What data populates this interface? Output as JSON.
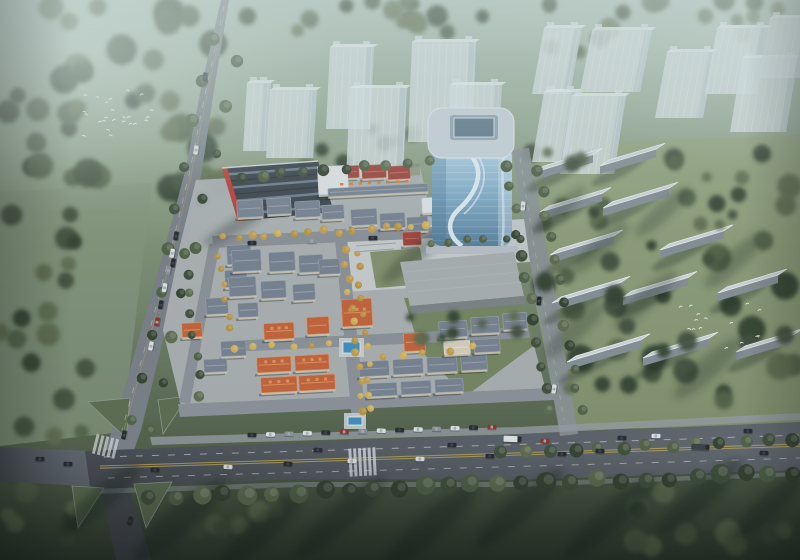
{
  "palette": {
    "g_base_1": "#a9bcb4",
    "g_base_2": "#99ab97",
    "g_base_3": "#87987d",
    "g_base_4": "#72826a",
    "g_base_5": "#55634c",
    "g_base_6": "#333f30",
    "forest_dark": "#33402f",
    "forest_mid": "#3f4d3a",
    "forest_light": "#4f5f45",
    "forest_pale": "#5d6b4e",
    "meadow": "#83937b",
    "lawn_right": "#93a179",
    "grass_island": "#5a6a4e",
    "garden_green": "#6f7f59",
    "lawn_pocket": "#7b8a63",
    "asphalt": "#545960",
    "asphalt_dark": "#43474e",
    "road_mist": "#787d85",
    "street": "#8a8f96",
    "paving": "#aeb2b6",
    "plaza": "#c6cacd",
    "sidewalk": "#949aa1",
    "lane_yellow": "#b5a057",
    "lane_white": "#d6dade",
    "ghost_body": "#d7e0e6",
    "ghost_shade": "#aebcc4",
    "ghost_roof": "#eaf0f3",
    "glass_1": "#b3d2e6",
    "glass_2": "#7fa9c7",
    "glass_3": "#577f9c",
    "swoosh": "#eef6fa",
    "tower_roof": "#c7d1d9",
    "tower_inset_frame": "#8fa3b2",
    "tower_inset": "#5d7689",
    "tower_base": "#b6bdc4",
    "sawtooth_dark": "#39414a",
    "sawtooth_glass": "#6c7d8d",
    "accent_red": "#bf3a31",
    "parapet": "#cdd3d8",
    "roof_gray": "#76808f",
    "roof_gray_ridge": "#9aa3af",
    "roof_orange": "#c2613a",
    "roof_orange_ridge": "#e0935c",
    "roof_red": "#9c423a",
    "roof_red_ridge": "#c4685c",
    "roof_cream": "#d6cdbd",
    "wall_light": "#e0e3e6",
    "wall_cream": "#cfc5b4",
    "slab_roof": "#ccd3d8",
    "slab_face": "#848d94",
    "slab_edge": "#eef2f4",
    "tree_yellow_1": "#c19c49",
    "tree_yellow_2": "#d1af57",
    "tree_yellow_3": "#b8933f",
    "pool": "#3e8cba",
    "pool_deck": "#c9cdd0",
    "car_dark": "#23272c",
    "car_white": "#dde1e4",
    "car_red": "#8e2f26",
    "car_gray": "#8b9097",
    "truck_trailer": "#3a3f45",
    "bird": "#f2f5f3",
    "shadow": "#16211a",
    "awning": "#d97f35"
  },
  "scene": {
    "forest_regions": [
      [
        5,
        5,
        220,
        195,
        40,
        8,
        16
      ],
      [
        0,
        195,
        92,
        195,
        14,
        7,
        12
      ],
      [
        228,
        0,
        290,
        38,
        14,
        6,
        11
      ],
      [
        300,
        118,
        130,
        48,
        8,
        5,
        9
      ],
      [
        528,
        148,
        268,
        255,
        30,
        7,
        14
      ],
      [
        580,
        492,
        220,
        62,
        12,
        8,
        14
      ],
      [
        0,
        388,
        82,
        170,
        12,
        7,
        12
      ],
      [
        150,
        498,
        130,
        58,
        8,
        7,
        11
      ],
      [
        530,
        0,
        268,
        52,
        16,
        6,
        11
      ]
    ],
    "forest_after": [
      [
        532,
        150,
        262,
        250,
        24,
        5,
        10
      ],
      [
        404,
        300,
        118,
        44,
        10,
        4,
        7
      ]
    ],
    "tree_rows": [
      {
        "x1": 150,
        "y1": 497,
        "x2": 795,
        "y2": 473,
        "n": 27,
        "rmin": 7,
        "rmax": 10,
        "kind": "green"
      },
      {
        "x1": 500,
        "y1": 452,
        "x2": 795,
        "y2": 441,
        "n": 13,
        "rmin": 5.5,
        "rmax": 7.5,
        "kind": "green"
      },
      {
        "x1": 212,
        "y1": 38,
        "x2": 132,
        "y2": 418,
        "n": 10,
        "rmin": 5,
        "rmax": 7,
        "kind": "green"
      },
      {
        "x1": 236,
        "y1": 62,
        "x2": 152,
        "y2": 430,
        "n": 9,
        "rmin": 4.5,
        "rmax": 6.5,
        "kind": "green"
      },
      {
        "x1": 506,
        "y1": 166,
        "x2": 549,
        "y2": 410,
        "n": 12,
        "rmin": 4.5,
        "rmax": 6,
        "kind": "green"
      },
      {
        "x1": 539,
        "y1": 172,
        "x2": 581,
        "y2": 412,
        "n": 12,
        "rmin": 4.5,
        "rmax": 6,
        "kind": "green"
      },
      {
        "x1": 344,
        "y1": 250,
        "x2": 362,
        "y2": 412,
        "n": 12,
        "rmin": 3,
        "rmax": 4.2,
        "kind": "yellow"
      },
      {
        "x1": 356,
        "y1": 252,
        "x2": 373,
        "y2": 410,
        "n": 11,
        "rmin": 2.8,
        "rmax": 3.8,
        "kind": "yellow"
      },
      {
        "x1": 222,
        "y1": 237,
        "x2": 428,
        "y2": 226,
        "n": 15,
        "rmin": 3,
        "rmax": 4.2,
        "kind": "yellow"
      },
      {
        "x1": 216,
        "y1": 254,
        "x2": 231,
        "y2": 330,
        "n": 6,
        "rmin": 2.8,
        "rmax": 3.8,
        "kind": "yellow"
      },
      {
        "x1": 430,
        "y1": 243,
        "x2": 522,
        "y2": 237,
        "n": 6,
        "rmin": 3.5,
        "rmax": 4.5,
        "kind": "green"
      },
      {
        "x1": 240,
        "y1": 176,
        "x2": 430,
        "y2": 163,
        "n": 10,
        "rmin": 4.5,
        "rmax": 6,
        "kind": "green"
      },
      {
        "x1": 186,
        "y1": 254,
        "x2": 200,
        "y2": 396,
        "n": 8,
        "rmin": 4,
        "rmax": 5.5,
        "kind": "green"
      },
      {
        "x1": 236,
        "y1": 348,
        "x2": 330,
        "y2": 342,
        "n": 6,
        "rmin": 3,
        "rmax": 4,
        "kind": "yellow"
      },
      {
        "x1": 380,
        "y1": 356,
        "x2": 470,
        "y2": 348,
        "n": 5,
        "rmin": 3,
        "rmax": 4,
        "kind": "yellow"
      }
    ],
    "ghost_towers_center": {
      "lean": 4,
      "items": [
        [
          243,
          83,
          24,
          68
        ],
        [
          266,
          90,
          47,
          68
        ],
        [
          326,
          47,
          44,
          82
        ],
        [
          346,
          88,
          57,
          90
        ],
        [
          408,
          42,
          64,
          100
        ],
        [
          446,
          85,
          52,
          76
        ]
      ]
    },
    "ghost_towers_right": {
      "lean": 12,
      "items": [
        [
          532,
          28,
          38,
          66
        ],
        [
          580,
          30,
          60,
          62
        ],
        [
          655,
          52,
          48,
          66
        ],
        [
          705,
          28,
          51,
          66
        ],
        [
          730,
          58,
          56,
          74
        ],
        [
          758,
          18,
          42,
          60
        ],
        [
          532,
          92,
          34,
          70
        ],
        [
          560,
          96,
          54,
          78
        ]
      ]
    },
    "slabs": [
      [
        540,
        212,
        62
      ],
      [
        603,
        208,
        66
      ],
      [
        550,
        255,
        64
      ],
      [
        660,
        250,
        64
      ],
      [
        552,
        303,
        69
      ],
      [
        623,
        297,
        65
      ],
      [
        718,
        293,
        60
      ],
      [
        567,
        362,
        74
      ],
      [
        643,
        358,
        66
      ],
      [
        736,
        352,
        58
      ],
      [
        535,
        172,
        58
      ],
      [
        600,
        166,
        56
      ]
    ],
    "villas": [
      [
        337,
        166,
        22,
        12,
        "red"
      ],
      [
        362,
        165,
        24,
        13,
        "red"
      ],
      [
        388,
        166,
        22,
        13,
        "red"
      ],
      [
        237,
        200,
        26,
        17,
        "gray"
      ],
      [
        267,
        198,
        24,
        16,
        "gray"
      ],
      [
        295,
        201,
        25,
        16,
        "gray"
      ],
      [
        322,
        205,
        22,
        14,
        "gray"
      ],
      [
        351,
        209,
        26,
        16,
        "gray"
      ],
      [
        380,
        213,
        25,
        15,
        "gray"
      ],
      [
        407,
        217,
        21,
        14,
        "gray"
      ],
      [
        227,
        245,
        24,
        19,
        "gray"
      ],
      [
        225,
        270,
        22,
        17,
        "gray"
      ],
      [
        206,
        298,
        22,
        16,
        "gray"
      ],
      [
        238,
        303,
        20,
        14,
        "gray"
      ],
      [
        182,
        323,
        20,
        14,
        "orange"
      ],
      [
        221,
        341,
        25,
        15,
        "gray"
      ],
      [
        204,
        359,
        23,
        13,
        "gray"
      ],
      [
        232,
        250,
        29,
        21,
        "gray"
      ],
      [
        269,
        252,
        26,
        19,
        "gray"
      ],
      [
        299,
        255,
        24,
        17,
        "gray"
      ],
      [
        229,
        277,
        27,
        19,
        "gray"
      ],
      [
        261,
        281,
        25,
        17,
        "gray"
      ],
      [
        293,
        284,
        22,
        16,
        "gray"
      ],
      [
        319,
        259,
        21,
        15,
        "gray"
      ],
      [
        264,
        323,
        30,
        16,
        "orange"
      ],
      [
        307,
        317,
        22,
        17,
        "orange"
      ],
      [
        342,
        299,
        30,
        27,
        "orange"
      ],
      [
        404,
        333,
        21,
        18,
        "orange"
      ],
      [
        403,
        232,
        18,
        13,
        "red"
      ],
      [
        422,
        197,
        44,
        15,
        "light"
      ],
      [
        318,
        166,
        30,
        28,
        "light"
      ],
      [
        328,
        186,
        100,
        8,
        "gray"
      ],
      [
        257,
        357,
        34,
        15,
        "orange"
      ],
      [
        295,
        355,
        34,
        15,
        "orange"
      ],
      [
        261,
        377,
        36,
        15,
        "orange"
      ],
      [
        299,
        375,
        36,
        15,
        "orange"
      ],
      [
        359,
        361,
        30,
        15,
        "gray"
      ],
      [
        393,
        359,
        30,
        15,
        "gray"
      ],
      [
        427,
        357,
        30,
        15,
        "gray"
      ],
      [
        461,
        355,
        26,
        15,
        "gray"
      ],
      [
        367,
        383,
        30,
        13,
        "gray"
      ],
      [
        401,
        381,
        30,
        13,
        "gray"
      ],
      [
        435,
        379,
        28,
        13,
        "gray"
      ],
      [
        439,
        321,
        28,
        16,
        "gray"
      ],
      [
        471,
        317,
        28,
        16,
        "gray"
      ],
      [
        503,
        313,
        24,
        16,
        "gray"
      ],
      [
        444,
        341,
        26,
        13,
        "cream"
      ],
      [
        474,
        339,
        26,
        13,
        "gray"
      ]
    ],
    "awnings": {
      "x1": 340,
      "y1": 183,
      "x2": 405,
      "y2": 180,
      "n": 8
    },
    "pools": [
      [
        343,
        342,
        17,
        11
      ],
      [
        348,
        417,
        14,
        8
      ]
    ],
    "cars": [
      [
        155,
        470,
        3,
        "dark"
      ],
      [
        228,
        467,
        3,
        "white"
      ],
      [
        288,
        464,
        3,
        "dark"
      ],
      [
        318,
        450,
        3,
        "dark"
      ],
      [
        352,
        461,
        2,
        "white"
      ],
      [
        420,
        459,
        2,
        "white"
      ],
      [
        452,
        445,
        2,
        "dark"
      ],
      [
        490,
        456,
        2,
        "dark"
      ],
      [
        512,
        439,
        2,
        "truck_white"
      ],
      [
        545,
        441,
        2,
        "red"
      ],
      [
        562,
        454,
        2,
        "dark"
      ],
      [
        600,
        451,
        2,
        "dark"
      ],
      [
        622,
        438,
        2,
        "dark"
      ],
      [
        656,
        436,
        2,
        "white"
      ],
      [
        700,
        447,
        2,
        "truck_dark"
      ],
      [
        748,
        431,
        2,
        "dark"
      ],
      [
        764,
        453,
        2,
        "dark"
      ],
      [
        205,
        77,
        -82,
        "dark"
      ],
      [
        196,
        150,
        -81,
        "white"
      ],
      [
        173,
        263,
        -80,
        "dark"
      ],
      [
        151,
        346,
        -79,
        "white"
      ],
      [
        124,
        435,
        -78,
        "dark"
      ],
      [
        40,
        459,
        2,
        "dark"
      ],
      [
        68,
        464,
        2,
        "dark"
      ],
      [
        130,
        521,
        -76,
        "dark"
      ],
      [
        523,
        206,
        -84,
        "white"
      ],
      [
        539,
        301,
        -83,
        "dark"
      ],
      [
        554,
        389,
        -82,
        "white"
      ],
      [
        252,
        243,
        -2,
        "dark"
      ],
      [
        312,
        241,
        -2,
        "gray"
      ],
      [
        373,
        238,
        -2,
        "dark"
      ]
    ],
    "parked_rows": [
      {
        "x1": 252,
        "y1": 435,
        "x2": 492,
        "y2": 427,
        "n": 14,
        "rot": 2
      },
      {
        "x1": 176,
        "y1": 236,
        "x2": 157,
        "y2": 322,
        "n": 6,
        "rot": -80
      }
    ],
    "bird_flocks": [
      {
        "cx": 118,
        "cy": 112,
        "sx": 36,
        "sy": 25,
        "n": 24
      },
      {
        "cx": 722,
        "cy": 326,
        "sx": 46,
        "sy": 26,
        "n": 15
      }
    ],
    "ground_shadows": [
      [
        100,
        500,
        52,
        12,
        0.38
      ],
      [
        180,
        520,
        60,
        14,
        0.38
      ],
      [
        260,
        532,
        55,
        13,
        0.38
      ],
      [
        340,
        518,
        60,
        13,
        0.38
      ],
      [
        430,
        527,
        62,
        14,
        0.38
      ],
      [
        520,
        508,
        58,
        13,
        0.38
      ],
      [
        610,
        518,
        60,
        13,
        0.38
      ],
      [
        700,
        497,
        55,
        12,
        0.38
      ],
      [
        768,
        507,
        45,
        11,
        0.38
      ],
      [
        575,
        330,
        40,
        10,
        0.26
      ],
      [
        645,
        300,
        42,
        10,
        0.26
      ],
      [
        708,
        368,
        45,
        11,
        0.26
      ],
      [
        600,
        248,
        38,
        9,
        0.26
      ],
      [
        662,
        212,
        36,
        9,
        0.26
      ],
      [
        735,
        260,
        40,
        10,
        0.26
      ],
      [
        560,
        210,
        34,
        8,
        0.26
      ]
    ]
  }
}
